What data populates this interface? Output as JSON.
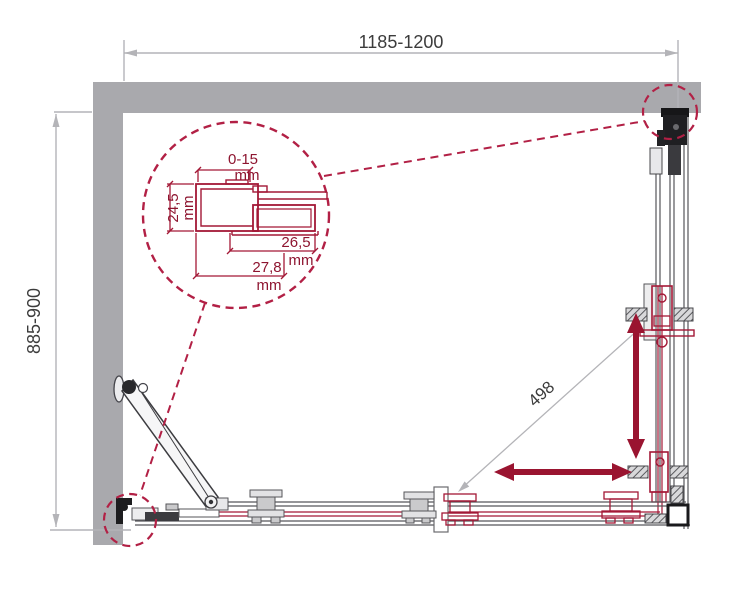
{
  "diagram": {
    "name": "Shower enclosure installation diagram (plan view)",
    "overall": {
      "width_label": "1185-1200",
      "depth_label": "885-900",
      "travel_label": "498"
    },
    "detail_callout": {
      "adjustment": {
        "value": "0-15",
        "unit": "mm"
      },
      "profile_depth": {
        "value": "24,5",
        "unit": "mm"
      },
      "inner_width": {
        "value": "26,5",
        "unit": "mm"
      },
      "outer_width": {
        "value": "27,8",
        "unit": "mm"
      }
    },
    "colors": {
      "accent_maroon": "#9a1430",
      "callout_crimson": "#b22045",
      "wall_gray": "#a9a9ad",
      "dimension_gray": "#b4b4b8",
      "text_dark": "#3c3c3c"
    }
  }
}
